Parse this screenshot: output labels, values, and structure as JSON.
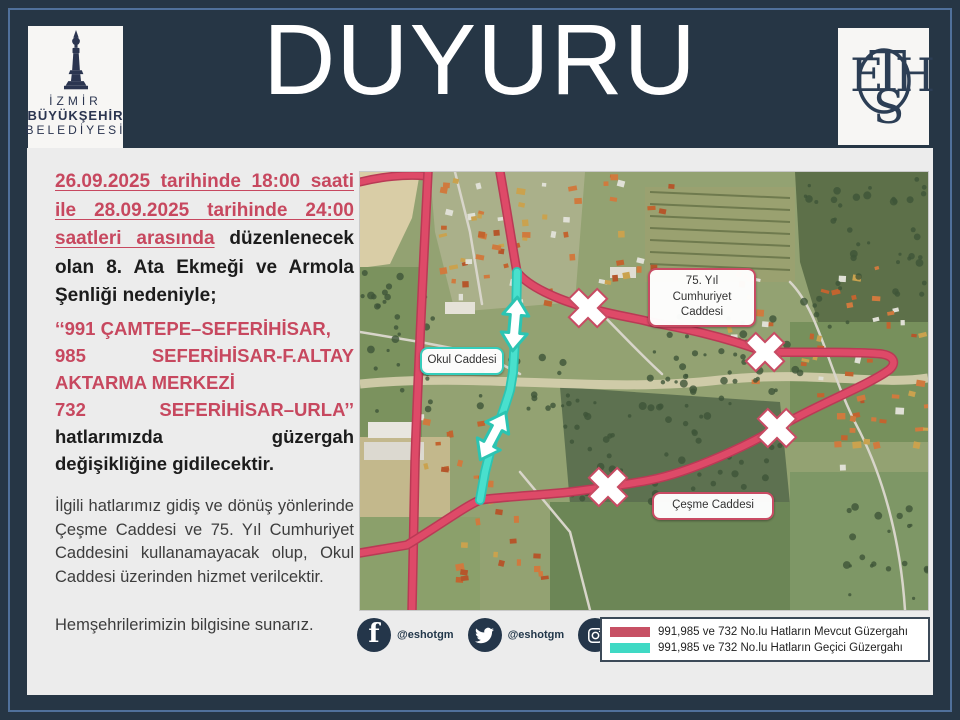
{
  "header": {
    "title": "DUYURU",
    "left_logo": {
      "line1": "İZMİR",
      "line2": "BÜYÜKŞEHİR",
      "line3": "BELEDİYESİ",
      "icon": "izmir-clock-tower-icon"
    },
    "right_logo": {
      "monogram": "ESHOT",
      "icon": "eshot-monogram-icon"
    }
  },
  "announcement": {
    "para1_red": "26.09.2025 tarihinde 18:00 saati ile 28.09.2025 tarihinde 24:00 saatleri arasında",
    "para1_black": "düzenlenecek olan 8. Ata Ekmeği ve Armola Şenliği nedeniyle;",
    "routes": {
      "line1": "‘‘991 ÇAMTEPE–SEFERİHİSAR,",
      "line2_left": "985",
      "line2_right": "SEFERİHİSAR-F.ALTAY",
      "line3": "AKTARMA MERKEZİ",
      "line4_left": "732",
      "line4_right": "SEFERİHİSAR–URLA’’",
      "line5_left": "hatlarımızda",
      "line5_right": "güzergah",
      "line6": "değişikliğine gidilecektir."
    },
    "para3": "İlgili hatlarımız gidiş ve dönüş yönlerinde Çeşme Caddesi ve 75. Yıl Cumhuriyet Caddesini kullanamayacak olup, Okul Caddesi üzerinden hizmet verilcektir.",
    "para4": "Hemşehrilerimizin bilgisine sunarız."
  },
  "map": {
    "labels": [
      {
        "text": "75. Yıl Cumhuriyet Caddesi",
        "border_color": "#C84B63"
      },
      {
        "text": "Okul Caddesi",
        "border_color": "#35CDBB"
      },
      {
        "text": "Çeşme Caddesi",
        "border_color": "#C84B63"
      }
    ],
    "markers": {
      "closed_x_count": 4,
      "temporary_arrow_count": 2
    }
  },
  "footer": {
    "social": [
      {
        "icon": "facebook-icon",
        "handle": "@eshotgm"
      },
      {
        "icon": "twitter-icon",
        "handle": "@eshotgm"
      },
      {
        "icon": "instagram-icon",
        "handle": "@eshotgm"
      }
    ],
    "legend": [
      {
        "color": "#C75064",
        "label": "991,985 ve 732 No.lu Hatların Mevcut Güzergahı"
      },
      {
        "color": "#3FD9C4",
        "label": "991,985 ve 732 No.lu Hatların Geçici Güzergahı"
      }
    ]
  },
  "colors": {
    "background_navy": "#263645",
    "panel_gray": "#ECECEC",
    "accent_crimson": "#C7485F",
    "route_red": "#DE4A68",
    "route_teal": "#3FD9C4"
  }
}
